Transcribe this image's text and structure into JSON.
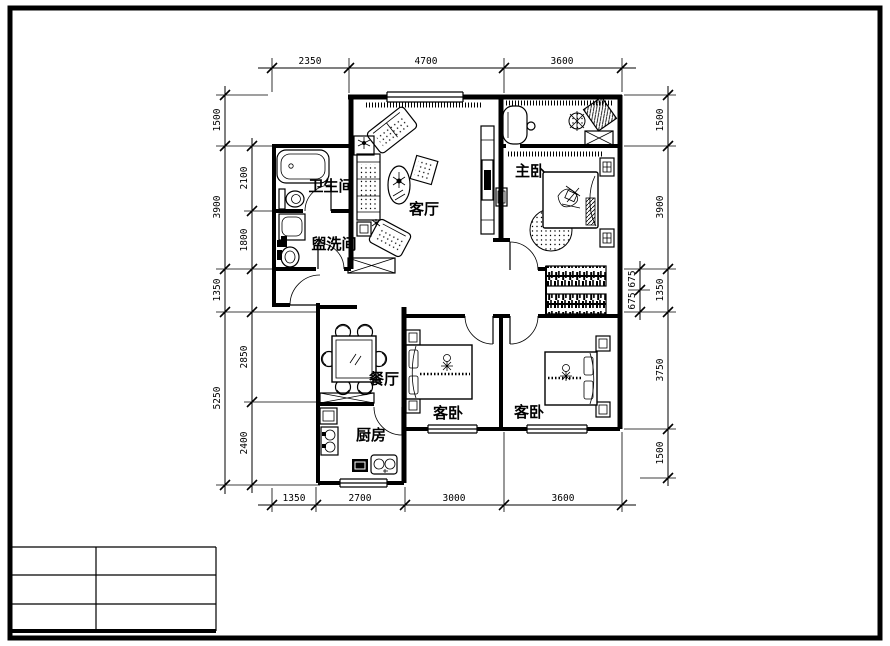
{
  "drawing": {
    "type": "apartment floor plan (CAD)",
    "colors": {
      "line": "#000000",
      "paper": "#ffffff"
    }
  },
  "rooms": {
    "bathroom": "卫生间",
    "washroom": "盥洗间",
    "living": "客厅",
    "master": "主卧",
    "dining": "餐厅",
    "kitchen": "厨房",
    "guest1": "客卧",
    "guest2": "客卧"
  },
  "dims": {
    "top": [
      "2350",
      "4700",
      "3600"
    ],
    "bottom": [
      "1350",
      "2700",
      "3000",
      "3600"
    ],
    "left_outer": [
      "1500",
      "3900",
      "1350",
      "5250"
    ],
    "left_inner": [
      "2100",
      "1800",
      "2850",
      "2400"
    ],
    "right_outer": [
      "1500",
      "3900",
      "1350",
      "3750",
      "1500"
    ],
    "right_inner": [
      "675",
      "675"
    ]
  },
  "title_block": {
    "rows": 3,
    "columns": 2,
    "cells": [
      "",
      "",
      "",
      "",
      "",
      ""
    ]
  }
}
